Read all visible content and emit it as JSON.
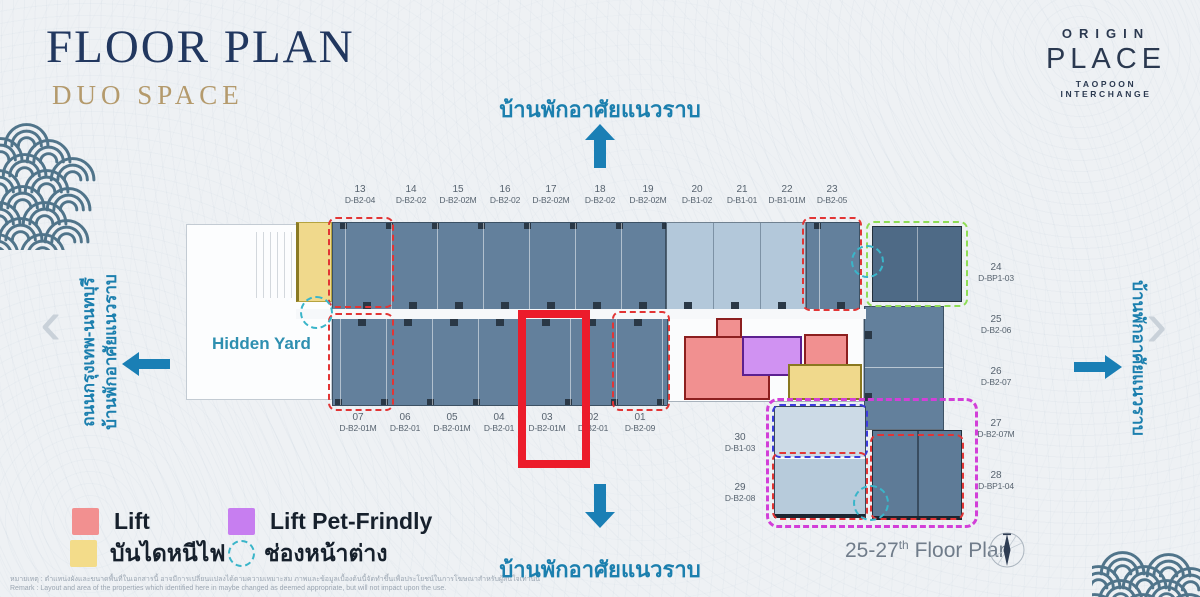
{
  "header": {
    "title": "FLOOR PLAN",
    "subtitle": "DUO SPACE"
  },
  "logo": {
    "brand": "ORIGIN",
    "name": "PLACE",
    "tagline": "TAOPOON INTERCHANGE"
  },
  "surroundings": {
    "top": "บ้านพักอาศัยแนวราบ",
    "bottom": "บ้านพักอาศัยแนวราบ",
    "left_line1": "ถนนกรุงเทพ-นนทบุรี",
    "left_line2": "บ้านพักอาศัยแนวราบ",
    "right": "บ้านพักอาศัยแนวราบ"
  },
  "plan": {
    "hidden_yard_label": "Hidden Yard",
    "top_units": [
      {
        "no": "13",
        "code": "D-B2-04"
      },
      {
        "no": "14",
        "code": "D-B2-02"
      },
      {
        "no": "15",
        "code": "D-B2-02M"
      },
      {
        "no": "16",
        "code": "D-B2-02"
      },
      {
        "no": "17",
        "code": "D-B2-02M"
      },
      {
        "no": "18",
        "code": "D-B2-02"
      },
      {
        "no": "19",
        "code": "D-B2-02M"
      },
      {
        "no": "20",
        "code": "D-B1-02"
      },
      {
        "no": "21",
        "code": "D-B1-01"
      },
      {
        "no": "22",
        "code": "D-B1-01M"
      },
      {
        "no": "23",
        "code": "D-B2-05"
      }
    ],
    "bottom_units": [
      {
        "no": "07",
        "code": "D-B2-01M"
      },
      {
        "no": "06",
        "code": "D-B2-01"
      },
      {
        "no": "05",
        "code": "D-B2-01M"
      },
      {
        "no": "04",
        "code": "D-B2-01"
      },
      {
        "no": "03",
        "code": "D-B2-01M"
      },
      {
        "no": "02",
        "code": "D-B2-01"
      },
      {
        "no": "01",
        "code": "D-B2-09"
      }
    ],
    "right_units": [
      {
        "no": "24",
        "code": "D-BP1-03"
      },
      {
        "no": "25",
        "code": "D-B2-06"
      },
      {
        "no": "26",
        "code": "D-B2-07"
      },
      {
        "no": "27",
        "code": "D-B2-07M"
      },
      {
        "no": "28",
        "code": "D-BP1-04"
      }
    ],
    "inner_units": [
      {
        "no": "30",
        "code": "D-B1-03"
      },
      {
        "no": "29",
        "code": "D-B2-08"
      }
    ]
  },
  "legend": {
    "lift": "Lift",
    "lift_pet": "Lift Pet-Frindly",
    "fire_stairs": "บันไดหนีไฟ",
    "window": "ช่องหน้าต่าง"
  },
  "footer": {
    "floor_range": "25-27",
    "floor_sup": "th",
    "floor_text": " Floor Plan"
  },
  "disclaimer": {
    "thai": "หมายเหตุ : ตำแหน่งผังและขนาดพื้นที่ในเอกสารนี้ อาจมีการเปลี่ยนแปลงได้ตามความเหมาะสม ภาพและข้อมูลเบื้องต้นนี้จัดทำขึ้นเพื่อประโยชน์ในการโฆษณาสำหรับผู้สนใจเท่านั้น",
    "english": "Remark : Layout and area of the properties which identified here in maybe changed as deemed appropriate, but will not impact upon the use."
  },
  "colors": {
    "accent_red": "#EC1C2B",
    "unit_dark": "#63809C",
    "unit_light": "#B3C8DA",
    "lift_pink": "#F19090",
    "lift_purple": "#D092F2",
    "stairs_yellow": "#F0D98C",
    "window_teal": "#3AB5C9",
    "dash_red": "#E23535",
    "dash_green": "#8FDD55",
    "dash_magenta": "#D23FD8",
    "dash_blue": "#3C3CDC",
    "arrow_blue": "#1A7FB5",
    "title_navy": "#21375F",
    "subtitle_gold": "#B49A6C"
  }
}
